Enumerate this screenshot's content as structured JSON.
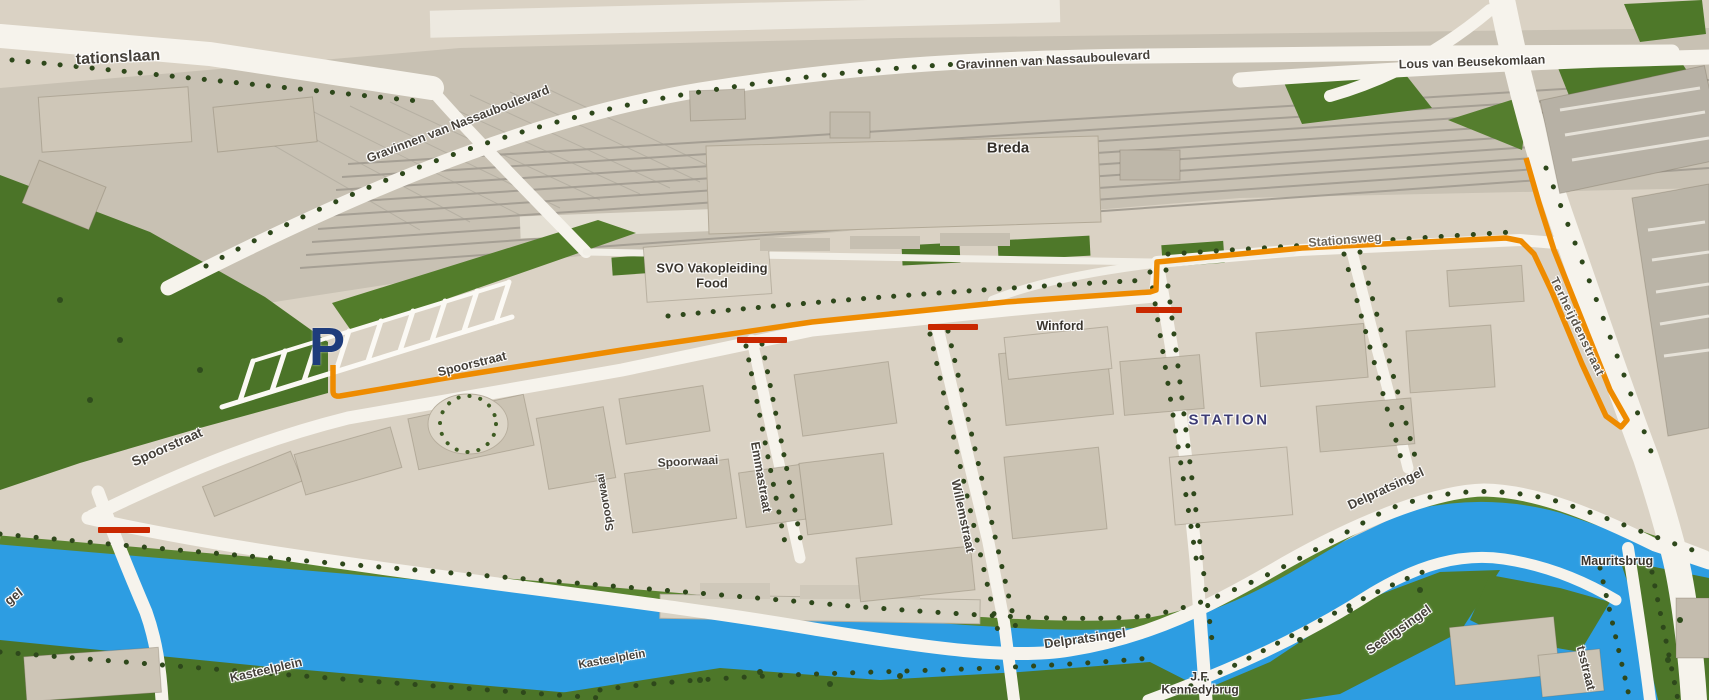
{
  "street_labels": {
    "stationslaan_partial": "tationslaan",
    "gravinnen_sw": "Gravinnen van Nassauboulevard",
    "gravinnen_north": "Gravinnen van Nassauboulevard",
    "lous_van_beusekomlaan": "Lous van Beusekomlaan",
    "stationsweg": "Stationsweg",
    "spoorstraat_east": "Spoorstraat",
    "spoorstraat_west": "Spoorstraat",
    "emmastraat": "Emmastraat",
    "spoorwaai_horizontal": "Spoorwaai",
    "spoorwaai_vertical": "Spoorwaai",
    "willemstraat": "Willemstraat",
    "terheijdenstraat": "Terheijdenstraat",
    "delpratsingel_east": "Delpratsingel",
    "delpratsingel_south": "Delpratsingel",
    "seeligsingel": "Seeligsingel",
    "kasteelplein_west": "Kasteelplein",
    "kasteelplein_east": "Kasteelplein",
    "singel_partial": "gel",
    "mauritsstraat_partial": "tsstraat"
  },
  "place_labels": {
    "city": "Breda",
    "station": "STATION",
    "svo_line1": "SVO Vakopleiding",
    "svo_line2": "Food",
    "winford": "Winford",
    "mauritsbrug": "Mauritsbrug",
    "kennedybrug_line1": "J.F.",
    "kennedybrug_line2": "Kennedybrug"
  },
  "markers": {
    "parking": "P"
  },
  "colors": {
    "route_orange": "#EE8B00",
    "barrier_red": "#C92800",
    "parking_blue": "#1E3C7C",
    "water_blue": "#2D9DE2"
  }
}
